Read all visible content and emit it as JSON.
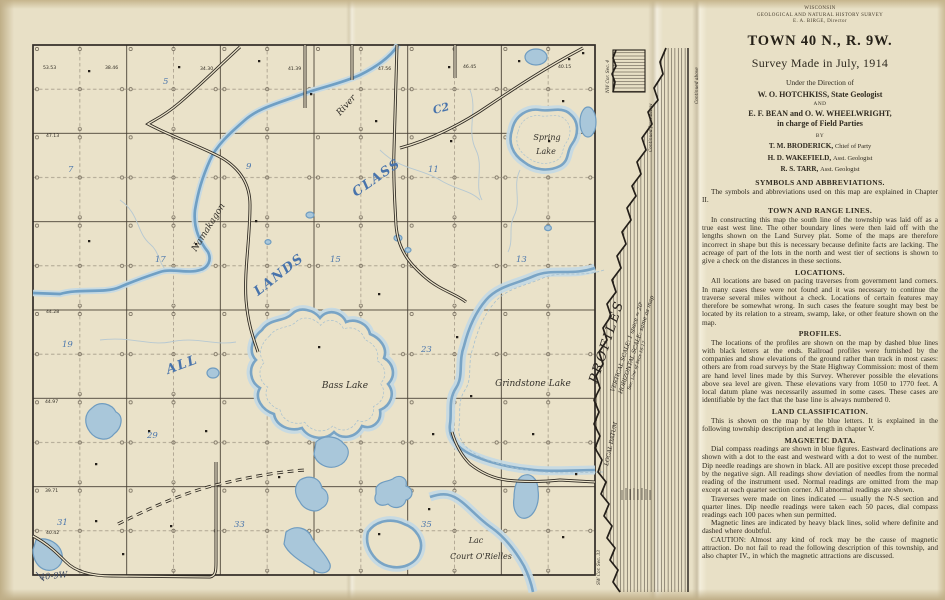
{
  "colors": {
    "paper": "#e9e1c8",
    "water_main": "#6f9fc4",
    "water_halo": "#c5d9e4",
    "class_blue": "#4873ab",
    "ink": "#2b2620"
  },
  "header": {
    "agency_small": "WISCONSIN",
    "agency_small2": "GEOLOGICAL AND NATURAL HISTORY SURVEY",
    "agency_small3": "E. A. BIRGE, Director",
    "title": "TOWN 40 N., R. 9W.",
    "subtitle": "Survey Made in July, 1914",
    "direction_line": "Under the Direction of",
    "geologist": "W. O. HOTCHKISS, State Geologist",
    "and_word": "AND",
    "field_chiefs": "E. F. BEAN and O. W. WHEELWRIGHT,",
    "field_chiefs2": "in charge of Field Parties",
    "by_word": "BY",
    "staff": [
      {
        "name": "T. M. BRODERICK,",
        "role": "Chief of Party"
      },
      {
        "name": "H. D. WAKEFIELD,",
        "role": "Asst. Geologist"
      },
      {
        "name": "R. S. TARR,",
        "role": "Asst. Geologist"
      }
    ]
  },
  "sections": [
    {
      "heading": "SYMBOLS AND ABBREVIATIONS.",
      "body": [
        "The symbols and abbreviations used on this map are explained in Chapter II."
      ]
    },
    {
      "heading": "TOWN AND RANGE LINES.",
      "body": [
        "In constructing this map the south line of the township was laid off as a true east west line. The other boundary lines were then laid off with the lengths shown on the Land Survey plat. Some of the maps are therefore incorrect in shape but this is necessary because definite facts are lacking.  The acreage of part of the lots in the north and west tier of sections is shown to give a check on the distances in these sections."
      ]
    },
    {
      "heading": "LOCATIONS.",
      "body": [
        "All locations are based on pacing traverses from government land corners.  In many cases these were not found and it was necessary to continue the traverse several miles without a check. Locations of certain features may therefore be somewhat wrong.  In such cases the feature sought may best be located by its relation to a stream, swamp, lake, or other feature shown on the map."
      ]
    },
    {
      "heading": "PROFILES.",
      "body": [
        "The locations of the profiles are shown on the map by dashed blue lines with black letters at the ends.  Railroad profiles were furnished by the companies and show elevations of the ground rather than track in most cases: others are from road surveys by the State Highway Commission: most of them are hand level lines made by this Survey.  Wherever possible the elevations above sea level are given.  These elevations vary from 1050 to 1770 feet.  A local datum plane was necessarily assumed in some cases.  These cases are identifiable by the fact that the base line is always numbered 0."
      ]
    },
    {
      "heading": "LAND CLASSIFICATION.",
      "body": [
        "This is shown on the map by the blue letters. It is explained in the following township description and at length in chapter V."
      ]
    },
    {
      "heading": "MAGNETIC DATA.",
      "body": [
        "Dial compass readings are shown in blue figures.  Eastward declinations are shown with a dot to the east and westward with a dot to west of the number.  Dip needle readings are shown in black.  All are positive except those preceded by the negative sign.  All readings show deviation of needles from the normal reading of the instrument used.  Normal readings are omitted from the map except at each quarter section corner.  All abnormal readings are shown.",
        "Traverses were made on lines indicated — usually the N-S section and quarter lines.  Dip needle readings were taken each 50 paces, dial compass readings each 100 paces when sun permitted.",
        "Magnetic lines are indicated by heavy black lines, solid where definite and dashed where doubtful.",
        "CAUTION:  Almost any kind of rock may be the cause of magnetic attraction.  Do not fail to read the following description of this township, and also chapter IV., in which the magnetic attractions are discussed."
      ]
    }
  ],
  "map": {
    "corner_label": "40-9W",
    "river_word1": "Namakagon",
    "river_word2": "River",
    "spring1": "Spring",
    "spring2": "Lake",
    "bass": "Bass Lake",
    "grindstone": "Grindstone Lake",
    "lac1": "Lac",
    "lac2": "Court O'Rielles",
    "class_all": "ALL",
    "class_lands": "LANDS",
    "class_class": "CLASS",
    "class_c2": "C2",
    "secnums": [
      "5",
      "7",
      "9",
      "11",
      "17",
      "15",
      "13",
      "19",
      "23",
      "29",
      "31",
      "33",
      "35"
    ],
    "lots": [
      "53.53",
      "38.46",
      "34.30",
      "41.39",
      "47.56",
      "46.45",
      "40.15",
      "47.13",
      "44.28",
      "44.97",
      "39.71",
      "40.42"
    ]
  },
  "profiles_panel": {
    "title": "PROFILES",
    "vertical_scale": "VERTICAL SCALE: 1 space = 20'",
    "horizontal_scale": "HORIZONTAL SCALE: same as map",
    "section_line": "Sec. Line of Secs 16-17",
    "local_datum": "LOCAL DATUM",
    "continued_above": "Continued above",
    "continued_below": "Continued from below",
    "nw_corner": "NW Cor. Sec. 4",
    "sw_corner": "SW Cor. Sec. 33"
  }
}
